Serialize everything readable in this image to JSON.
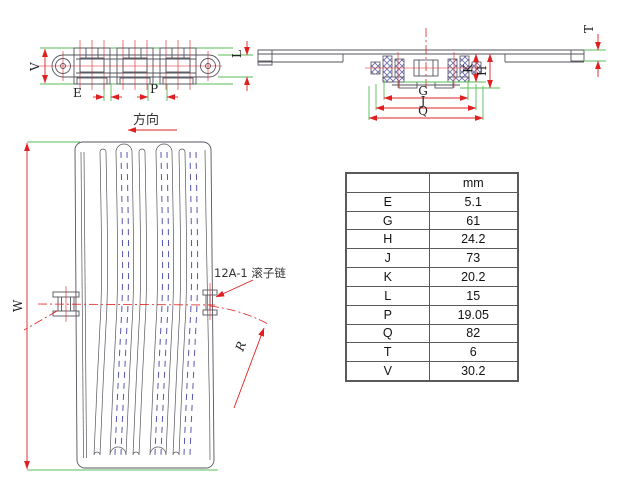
{
  "annotations": {
    "direction": "方向",
    "chain_type": "12A-1 滚子链"
  },
  "dims": {
    "V": "V",
    "E": "E",
    "P": "P",
    "L": "L",
    "T": "T",
    "K": "K",
    "H": "H",
    "G": "G",
    "J": "J",
    "Q": "Q",
    "W": "W",
    "R": "R"
  },
  "table": {
    "unit_header": "mm",
    "rows": [
      {
        "key": "E",
        "value": "5.1"
      },
      {
        "key": "G",
        "value": "61"
      },
      {
        "key": "H",
        "value": "24.2"
      },
      {
        "key": "J",
        "value": "73"
      },
      {
        "key": "K",
        "value": "20.2"
      },
      {
        "key": "L",
        "value": "15"
      },
      {
        "key": "P",
        "value": "19.05"
      },
      {
        "key": "Q",
        "value": "82"
      },
      {
        "key": "T",
        "value": "6"
      },
      {
        "key": "V",
        "value": "30.2"
      }
    ]
  },
  "colors": {
    "dimension_red": "#e02020",
    "extension_green": "#59bd59",
    "outline_gray": "#54545c",
    "hatch_blue": "#6a6aad",
    "hidden_blue": "#5656b0",
    "text_dark": "#222222",
    "table_border": "#5a5a5a"
  }
}
